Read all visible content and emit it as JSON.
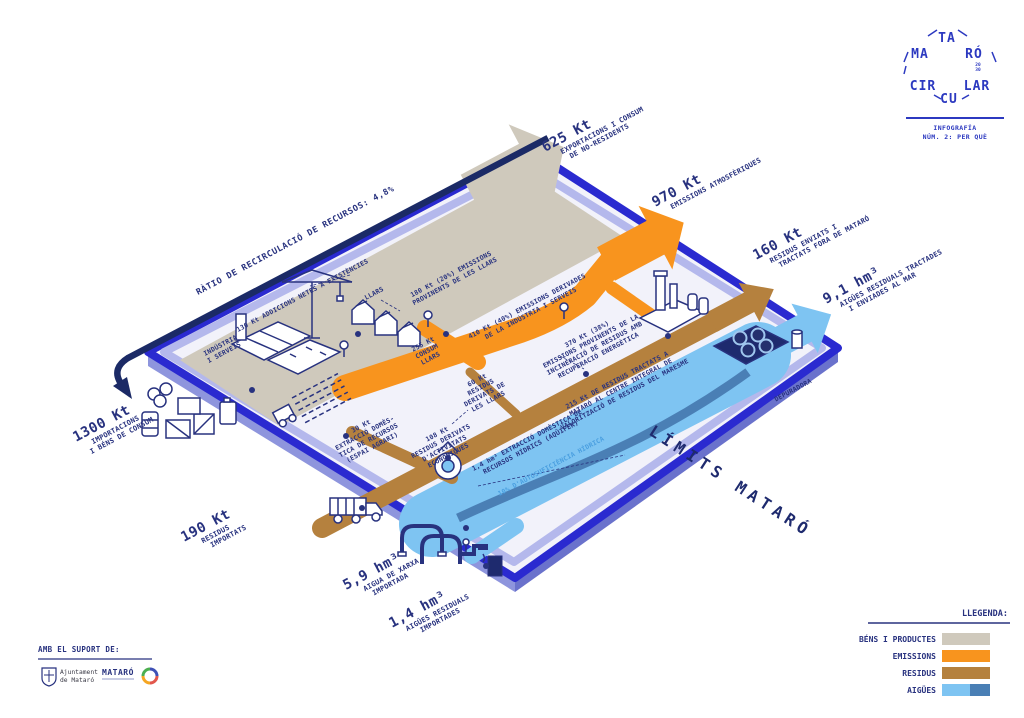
{
  "colors": {
    "brand_navy": "#28327f",
    "royal_blue": "#2a2ad0",
    "dark_arrow": "#1b2a66",
    "goods_gray": "#cfc9bc",
    "emissions_orange": "#f8941e",
    "waste_brown": "#b5813e",
    "water_light": "#7ec4f2",
    "water_dark": "#4a7fb5"
  },
  "logo": {
    "word_parts": [
      "MA",
      "TA",
      "RÓ",
      "CIR",
      "CU",
      "LAR"
    ],
    "year_top": "20",
    "year_bottom": "30",
    "subtitle1": "INFOGRAFÍA",
    "subtitle2": "NÚM. 2: PER QUÈ"
  },
  "boundary": {
    "label": "LÍMITS MATARÓ"
  },
  "ratio": {
    "label": "RÀTIO DE RECIRCULACIÓ DE RECURSOS: 4,8%"
  },
  "outflows": {
    "exports": {
      "value": "625 Kt",
      "lines": [
        "EXPORTACIONS I CONSUM",
        "DE NO-RESIDENTS"
      ]
    },
    "emissions": {
      "value": "970 Kt",
      "lines": [
        "EMISSIONS ATMOSFÈRIQUES"
      ]
    },
    "waste": {
      "value": "160 Kt",
      "lines": [
        "RESIDUS ENVIATS I",
        "TRACTATS FORA DE MATARÓ"
      ]
    },
    "water": {
      "value": "9,1 hm³",
      "lines": [
        "AIGÜES RESIDUALS TRACTADES",
        "I ENVIADES AL MAR"
      ]
    }
  },
  "inflows": {
    "imports": {
      "value": "1300 Kt",
      "lines": [
        "IMPORTACIONS",
        "I BÉNS DE CONSUM"
      ]
    },
    "waste": {
      "value": "190 Kt",
      "lines": [
        "RESIDUS",
        "IMPORTATS"
      ]
    },
    "network_water": {
      "value": "5,9 hm³",
      "lines": [
        "AIGUA DE XARXA",
        "IMPORTADA"
      ]
    },
    "wastewater": {
      "value": "1,4 hm³",
      "lines": [
        "AIGÜES RESIDUALS",
        "IMPORTADES"
      ]
    }
  },
  "inner_labels": {
    "additions": {
      "lines": [
        "130 Kt ADDICIONS NETES A EXISTÈNCIES"
      ]
    },
    "industry": {
      "lines": [
        "INDÚSTRIA",
        "I SERVEIS"
      ]
    },
    "households": {
      "lines": [
        "LLARS"
      ]
    },
    "household_emissions": {
      "lines": [
        "180 Kt (20%) EMISSIONS",
        "PROVINENTS DE LES LLARS"
      ]
    },
    "household_consumption": {
      "lines": [
        "255 Kt",
        "CONSUM",
        "LLARS"
      ]
    },
    "industry_emissions": {
      "lines": [
        "410 Kt (40%) EMISSIONS DERIVADES",
        "DE LA INDÚSTRIA I SERVEIS"
      ]
    },
    "incineration_emissions": {
      "lines": [
        "370 Kt (38%)",
        "EMISSIONS PROVINENTS DE LA",
        "INCINERACIÓ DE RESIDUS AMB",
        "RECUPERACIÓ ENERGÈTICA"
      ]
    },
    "household_waste": {
      "lines": [
        "60 Kt",
        "RESIDUS",
        "DERIVATS DE",
        "LES LLARS"
      ]
    },
    "treated_waste": {
      "lines": [
        "215 Kt DE RESIDUS TRACTATS A",
        "MATARÓ AL CENTRE INTEGRAL DE",
        "VALORITZACIÓ DE RESIDUS DEL MARESME"
      ]
    },
    "agrarian_extraction": {
      "lines": [
        "30 Kt",
        "EXTRACCIÓ DOMÈS-",
        "TICA DE RECURSOS",
        "(ESPAI AGRARI)"
      ]
    },
    "economic_waste": {
      "lines": [
        "108 Kt",
        "RESIDUS DERIVATS",
        "D'ACTIVITATS",
        "ECONÒMIQUES"
      ]
    },
    "water_extraction": {
      "lines": [
        "1,4 hm³ EXTRACCIÓ DOMÈSTICA DE",
        "RECURSOS HÍDRICS (AQÜÍFER)"
      ]
    },
    "water_self_sufficiency": {
      "lines": [
        "10% D'AUTOSUFICIÈNCIA HÍDRICA"
      ]
    },
    "treatment_plant": {
      "lines": [
        "DEPURADORA"
      ]
    }
  },
  "legend": {
    "title": "LLEGENDA:",
    "items": [
      {
        "label": "BÉNS I PRODUCTES",
        "color": "#cfc9bc"
      },
      {
        "label": "EMISSIONS",
        "color": "#f8941e"
      },
      {
        "label": "RESIDUS",
        "color": "#b5813e"
      },
      {
        "label": "AIGÜES",
        "color": "#7ec4f2",
        "color2": "#4a7fb5"
      }
    ]
  },
  "support": {
    "title": "AMB EL SUPORT DE:",
    "logo1_line1": "Ajuntament",
    "logo1_line2": "de Mataró",
    "logo2": "MATARÓ"
  }
}
